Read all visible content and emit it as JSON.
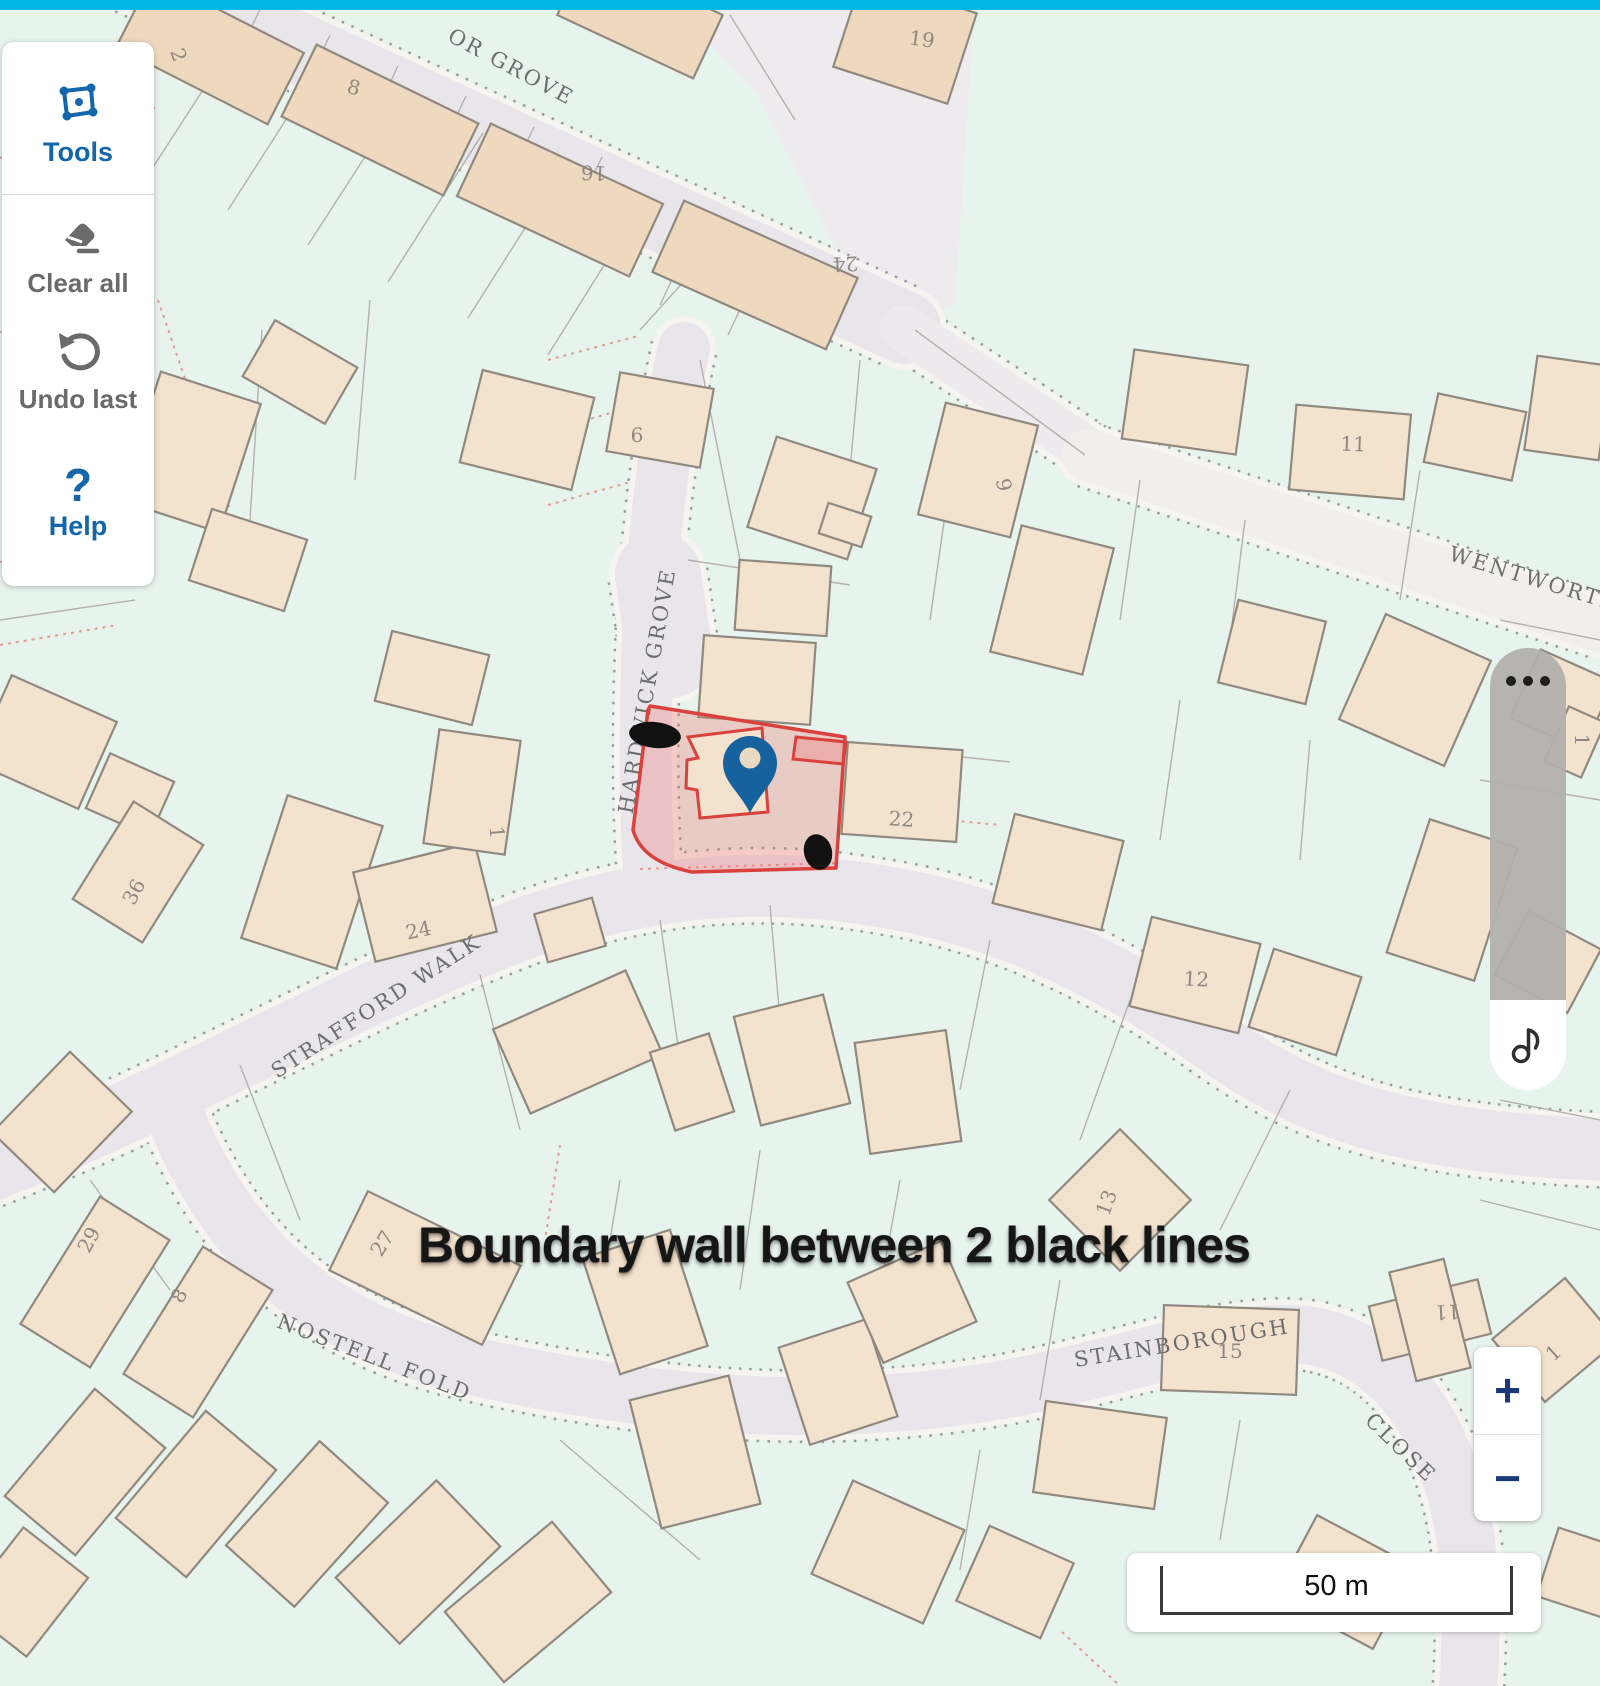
{
  "toolbar": {
    "tools_label": "Tools",
    "clear_label": "Clear all",
    "undo_label": "Undo last",
    "help_label": "Help",
    "help_glyph": "?"
  },
  "zoom_control": {
    "zoom_in": "+",
    "zoom_out": "−"
  },
  "scale": {
    "label": "50 m"
  },
  "annotation": {
    "text": "Boundary wall between 2 black lines"
  },
  "right_widget": {
    "dots_icon": "more-options",
    "note_icon": "music-note"
  },
  "colors": {
    "topbar": "#00b8e3",
    "map_bg": "#e7f4ed",
    "road_fill": "#e8e6ea",
    "road_light": "#f1efeb",
    "road_white": "#f6f4f1",
    "road_dot": "#9a9a9a",
    "building": "#f3e2cd",
    "terrace": "#eed9bf",
    "building_stroke": "#90897f",
    "parcel": "#b3b1ad",
    "parcel_red": "#e59a96",
    "highlight_stroke": "#d9413d",
    "highlight_fill": "rgba(238,110,108,0.30)",
    "pin_blue": "#15629f",
    "accent_blue": "#1266a9",
    "ui_gray": "#6a6a6a",
    "navy": "#1b3876",
    "ink": "#161616"
  },
  "map": {
    "areas": [
      {
        "points": "695,0 975,0 955,305 878,332 758,95 695,28",
        "fill": "#edebee"
      }
    ],
    "roads": [
      {
        "d": "M95 -45 L905 328",
        "w": 72
      },
      {
        "d": "M903 328 C 1000 392 1062 432 1098 458",
        "w": 46,
        "fill": "#eceaed"
      },
      {
        "d": "M684 348 C 666 430 652 540 648 640 C 645 720 644 800 650 882",
        "w": 52
      },
      {
        "d": "M658 575 L670 655",
        "w": 86
      },
      {
        "d": "M-30 1178 C 160 1108 340 998 525 928 C 655 883 765 876 885 897 C 1015 918 1125 978 1215 1042 C 1305 1106 1395 1142 1610 1150",
        "w": 62
      },
      {
        "d": "M172 1108 C 228 1252 322 1332 472 1366 C 652 1406 822 1420 1002 1390 C 1122 1368 1232 1324 1312 1336 C 1402 1352 1452 1442 1466 1542 C 1473 1612 1470 1662 1468 1695",
        "w": 58
      },
      {
        "d": "M1088 455 L1605 628",
        "w": 52,
        "fill": "#f1efeb"
      }
    ],
    "parcel_lines": [
      [
        163,
        0,
        68,
        140
      ],
      [
        243,
        28,
        148,
        175
      ],
      [
        323,
        62,
        228,
        210
      ],
      [
        403,
        98,
        308,
        245
      ],
      [
        483,
        133,
        388,
        282
      ],
      [
        563,
        168,
        468,
        318
      ],
      [
        643,
        203,
        548,
        355
      ],
      [
        723,
        238,
        640,
        330
      ],
      [
        795,
        120,
        730,
        15
      ],
      [
        0,
        332,
        148,
        355
      ],
      [
        148,
        355,
        120,
        560
      ],
      [
        262,
        330,
        250,
        520
      ],
      [
        370,
        300,
        355,
        480
      ],
      [
        0,
        620,
        135,
        600
      ],
      [
        700,
        360,
        740,
        560
      ],
      [
        860,
        360,
        850,
        470
      ],
      [
        915,
        330,
        1085,
        455
      ],
      [
        950,
        480,
        930,
        620
      ],
      [
        688,
        560,
        850,
        585
      ],
      [
        847,
        745,
        1010,
        762
      ],
      [
        1140,
        480,
        1120,
        620
      ],
      [
        1245,
        520,
        1230,
        640
      ],
      [
        1420,
        470,
        1400,
        600
      ],
      [
        1500,
        620,
        1600,
        640
      ],
      [
        1310,
        740,
        1300,
        860
      ],
      [
        1180,
        700,
        1160,
        840
      ],
      [
        1480,
        780,
        1600,
        800
      ],
      [
        240,
        1065,
        300,
        1220
      ],
      [
        480,
        975,
        520,
        1130
      ],
      [
        660,
        920,
        680,
        1060
      ],
      [
        770,
        905,
        780,
        1020
      ],
      [
        990,
        940,
        960,
        1090
      ],
      [
        1130,
        1000,
        1080,
        1140
      ],
      [
        1290,
        1090,
        1220,
        1230
      ],
      [
        90,
        1180,
        170,
        1290
      ],
      [
        620,
        1180,
        600,
        1300
      ],
      [
        760,
        1150,
        740,
        1290
      ],
      [
        900,
        1180,
        880,
        1290
      ],
      [
        1060,
        1280,
        1040,
        1400
      ],
      [
        560,
        1440,
        700,
        1560
      ],
      [
        980,
        1450,
        960,
        1570
      ],
      [
        1240,
        1420,
        1220,
        1540
      ],
      [
        1480,
        1200,
        1600,
        1230
      ],
      [
        1500,
        1100,
        1600,
        1120
      ],
      [
        262,
        5,
        222,
        90
      ],
      [
        330,
        35,
        290,
        120
      ],
      [
        398,
        66,
        358,
        150
      ],
      [
        466,
        96,
        426,
        180
      ],
      [
        534,
        127,
        494,
        210
      ],
      [
        602,
        157,
        562,
        240
      ],
      [
        700,
        220,
        660,
        305
      ],
      [
        768,
        250,
        728,
        335
      ]
    ],
    "red_dotted_lines": [
      [
        0,
        158,
        155,
        108
      ],
      [
        548,
        360,
        638,
        336
      ],
      [
        545,
        432,
        628,
        408
      ],
      [
        548,
        505,
        630,
        482
      ],
      [
        0,
        562,
        88,
        548
      ],
      [
        0,
        645,
        118,
        625
      ],
      [
        640,
        869,
        838,
        863
      ],
      [
        842,
        810,
        1000,
        825
      ],
      [
        560,
        1145,
        545,
        1240
      ],
      [
        1062,
        1632,
        1120,
        1686
      ],
      [
        158,
        300,
        230,
        510
      ]
    ],
    "buildings": [
      {
        "r": [
          210,
          50,
          170,
          80,
          27
        ],
        "f": "terrace"
      },
      {
        "r": [
          380,
          120,
          180,
          80,
          26
        ],
        "f": "terrace"
      },
      {
        "r": [
          560,
          200,
          190,
          80,
          25
        ],
        "f": "terrace"
      },
      {
        "r": [
          755,
          275,
          190,
          78,
          24
        ],
        "f": "terrace"
      },
      {
        "r": [
          640,
          15,
          150,
          70,
          25
        ],
        "f": "terrace"
      },
      {
        "r": [
          905,
          40,
          120,
          95,
          18
        ],
        "f": "terrace"
      },
      {
        "r": [
          300,
          372,
          95,
          65,
          30
        ]
      },
      {
        "r": [
          190,
          452,
          105,
          135,
          18
        ]
      },
      {
        "r": [
          248,
          560,
          100,
          75,
          18
        ]
      },
      {
        "r": [
          527,
          430,
          115,
          95,
          14
        ]
      },
      {
        "r": [
          660,
          420,
          95,
          80,
          10
        ]
      },
      {
        "r": [
          812,
          498,
          105,
          95,
          18
        ]
      },
      {
        "r": [
          978,
          470,
          95,
          115,
          14
        ]
      },
      {
        "r": [
          1052,
          600,
          95,
          130,
          14
        ]
      },
      {
        "r": [
          1185,
          402,
          115,
          90,
          8
        ]
      },
      {
        "r": [
          1350,
          452,
          115,
          85,
          5
        ]
      },
      {
        "r": [
          1475,
          437,
          90,
          70,
          12
        ]
      },
      {
        "r": [
          1568,
          408,
          75,
          95,
          8
        ]
      },
      {
        "r": [
          1272,
          652,
          90,
          85,
          14
        ]
      },
      {
        "r": [
          1415,
          690,
          115,
          115,
          24
        ]
      },
      {
        "r": [
          1562,
          700,
          80,
          75,
          24
        ]
      },
      {
        "r": [
          45,
          742,
          115,
          95,
          24
        ]
      },
      {
        "r": [
          130,
          795,
          70,
          60,
          24
        ]
      },
      {
        "r": [
          138,
          872,
          115,
          82,
          -58
        ]
      },
      {
        "r": [
          312,
          882,
          100,
          150,
          18
        ]
      },
      {
        "r": [
          425,
          902,
          125,
          92,
          -14
        ]
      },
      {
        "r": [
          472,
          792,
          82,
          115,
          8
        ]
      },
      {
        "r": [
          432,
          678,
          100,
          72,
          14
        ]
      },
      {
        "r": [
          757,
          680,
          112,
          82,
          4
        ]
      },
      {
        "r": [
          783,
          598,
          92,
          70,
          4
        ]
      },
      {
        "r": [
          902,
          792,
          115,
          92,
          4
        ]
      },
      {
        "r": [
          1058,
          872,
          112,
          92,
          14
        ]
      },
      {
        "r": [
          1195,
          975,
          112,
          92,
          14
        ]
      },
      {
        "r": [
          1305,
          1002,
          92,
          82,
          18
        ]
      },
      {
        "r": [
          1452,
          900,
          92,
          140,
          18
        ]
      },
      {
        "r": [
          1548,
          962,
          82,
          72,
          28
        ]
      },
      {
        "r": [
          578,
          1042,
          145,
          92,
          -24
        ]
      },
      {
        "r": [
          692,
          1082,
          62,
          82,
          -18
        ]
      },
      {
        "r": [
          792,
          1060,
          92,
          112,
          -14
        ]
      },
      {
        "r": [
          908,
          1092,
          92,
          112,
          -8
        ]
      },
      {
        "r": [
          1120,
          1200,
          100,
          100,
          45
        ]
      },
      {
        "r": [
          425,
          1268,
          170,
          88,
          26
        ]
      },
      {
        "r": [
          95,
          1282,
          150,
          82,
          -58
        ]
      },
      {
        "r": [
          198,
          1332,
          150,
          82,
          -58
        ]
      },
      {
        "r": [
          85,
          1472,
          140,
          92,
          -50
        ]
      },
      {
        "r": [
          196,
          1494,
          140,
          92,
          -50
        ]
      },
      {
        "r": [
          307,
          1524,
          140,
          92,
          -48
        ]
      },
      {
        "r": [
          418,
          1562,
          140,
          92,
          -44
        ]
      },
      {
        "r": [
          528,
          1602,
          140,
          92,
          -40
        ]
      },
      {
        "r": [
          25,
          1592,
          100,
          82,
          -52
        ]
      },
      {
        "r": [
          645,
          1302,
          92,
          122,
          -18
        ]
      },
      {
        "r": [
          695,
          1452,
          102,
          132,
          -14
        ]
      },
      {
        "r": [
          838,
          1382,
          92,
          102,
          -18
        ]
      },
      {
        "r": [
          912,
          1302,
          102,
          88,
          -24
        ]
      },
      {
        "r": [
          888,
          1552,
          122,
          102,
          24
        ]
      },
      {
        "r": [
          1015,
          1582,
          92,
          82,
          24
        ]
      },
      {
        "r": [
          1230,
          1350,
          135,
          85,
          2
        ]
      },
      {
        "r": [
          1430,
          1320,
          112,
          56,
          -14
        ]
      },
      {
        "r": [
          1430,
          1320,
          56,
          112,
          -14
        ]
      },
      {
        "r": [
          1555,
          1340,
          95,
          82,
          -40
        ]
      },
      {
        "r": [
          1100,
          1455,
          122,
          92,
          8
        ]
      },
      {
        "r": [
          1345,
          1582,
          112,
          92,
          28
        ]
      },
      {
        "r": [
          1588,
          1575,
          85,
          72,
          18
        ]
      },
      {
        "r": [
          62,
          1122,
          112,
          86,
          -46
        ]
      },
      {
        "r": [
          845,
          525,
          45,
          32,
          18
        ]
      },
      {
        "r": [
          570,
          930,
          60,
          50,
          -16
        ]
      },
      {
        "r": [
          1575,
          742,
          40,
          60,
          24
        ]
      }
    ],
    "street_labels": [
      {
        "t": "OR GROVE",
        "x": 508,
        "y": 73,
        "rot": 28
      },
      {
        "t": "HARDWICK GROVE",
        "x": 654,
        "y": 692,
        "rot": -80
      },
      {
        "t": "WENTWORTH",
        "x": 1533,
        "y": 586,
        "rot": 17
      },
      {
        "t": "STRAFFORD WALK",
        "x": 380,
        "y": 1012,
        "rot": -33
      },
      {
        "t": "NOSTELL FOLD",
        "x": 372,
        "y": 1364,
        "rot": 21
      },
      {
        "t": "STAINBOROUGH",
        "x": 1183,
        "y": 1350,
        "rot": -9
      },
      {
        "t": "CLOSE",
        "x": 1396,
        "y": 1453,
        "rot": 44
      }
    ],
    "house_numbers": [
      {
        "t": "2",
        "x": 172,
        "y": 57,
        "rot": 72
      },
      {
        "t": "8",
        "x": 352,
        "y": 94,
        "rot": 15
      },
      {
        "t": "16",
        "x": 594,
        "y": 166,
        "rot": 183
      },
      {
        "t": "24",
        "x": 845,
        "y": 257,
        "rot": 177
      },
      {
        "t": "19",
        "x": 921,
        "y": 46,
        "rot": 8
      },
      {
        "t": "6",
        "x": 637,
        "y": 442,
        "rot": 0
      },
      {
        "t": "9",
        "x": 997,
        "y": 486,
        "rot": 80
      },
      {
        "t": "11",
        "x": 1353,
        "y": 451,
        "rot": 2
      },
      {
        "t": "1",
        "x": 1575,
        "y": 740,
        "rot": 90
      },
      {
        "t": "36",
        "x": 140,
        "y": 895,
        "rot": -62
      },
      {
        "t": "24",
        "x": 420,
        "y": 937,
        "rot": -12
      },
      {
        "t": "1",
        "x": 490,
        "y": 833,
        "rot": 85
      },
      {
        "t": "22",
        "x": 901,
        "y": 826,
        "rot": 4
      },
      {
        "t": "12",
        "x": 1196,
        "y": 986,
        "rot": 3
      },
      {
        "t": "13",
        "x": 1113,
        "y": 1205,
        "rot": -70
      },
      {
        "t": "27",
        "x": 388,
        "y": 1247,
        "rot": -58
      },
      {
        "t": "29",
        "x": 95,
        "y": 1243,
        "rot": -62
      },
      {
        "t": "8",
        "x": 185,
        "y": 1299,
        "rot": -60
      },
      {
        "t": "11",
        "x": 1447,
        "y": 1305,
        "rot": 177
      },
      {
        "t": "15",
        "x": 1230,
        "y": 1358,
        "rot": 0
      },
      {
        "t": "1",
        "x": 1558,
        "y": 1358,
        "rot": -42
      }
    ],
    "highlight": {
      "outline": "M650 706 L845 737 L836 868 L692 872 Q642 862 633 830 L648 710 Z",
      "inner_building": "688,737 762,728 768,812 700,818 697,790 686,788 687,760 698,758",
      "inner_rect": "796,737 846,742 843,764 793,759",
      "marks": [
        {
          "cx": 655,
          "cy": 735,
          "rx": 26,
          "ry": 13,
          "rot": 6
        },
        {
          "cx": 818,
          "cy": 852,
          "rx": 14,
          "ry": 18,
          "rot": -14
        }
      ],
      "pin": {
        "x": 750,
        "y": 763,
        "tip_y": 813,
        "head_r": 27,
        "hole_r": 10.5,
        "hole_fill": "#e9d8c2"
      }
    }
  }
}
